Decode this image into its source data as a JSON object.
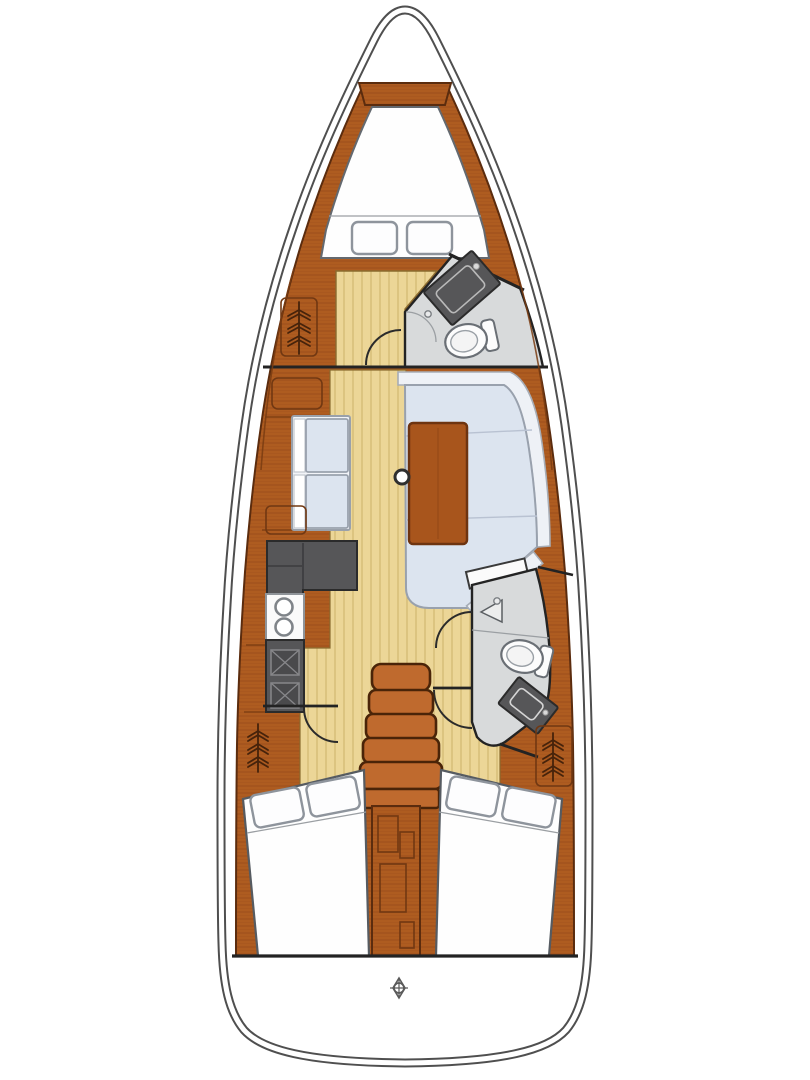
{
  "page": {
    "background": "#ffffff",
    "description": "Top-down interior floor plan diagram of a sailing yacht, bow pointing up, no visible text labels"
  },
  "colors": {
    "hull_line": "#4f4f4f",
    "hull_fill": "#ffffff",
    "wood": "#ae5c20",
    "wood_grain": "#96491a",
    "wood_edge": "#5b2c0e",
    "wood_light": "#b8652a",
    "table_wood": "#a8551c",
    "steps": "#bf6a2e",
    "steps_edge": "#4a2408",
    "floor": "#ecd697",
    "floor_line": "#c9ab62",
    "berth": "#fefefe",
    "berth_edge": "#60656d",
    "pillow": "#fdfdfe",
    "pillow_edge": "#8e949c",
    "cushion": "#dce4ef",
    "cushion_back": "#eef1f6",
    "cushion_edge": "#99a1ad",
    "counter": "#565658",
    "counter_inner": "#4a4a4c",
    "counter_edge": "#2b2b2b",
    "head_floor": "#d8dadb",
    "fixture": "#fcfcfc",
    "fixture_edge": "#6a6f75",
    "trim_dark": "#232323"
  },
  "rooms": [
    {
      "name": "anchor-locker",
      "position": "bow"
    },
    {
      "name": "forward-cabin",
      "features": [
        "v-berth-double-bed",
        "two-pillows",
        "hanging-locker",
        "door-swing-arc"
      ]
    },
    {
      "name": "forward-head",
      "features": [
        "toilet",
        "vanity-sink",
        "shower-drain",
        "shower-door-arc"
      ]
    },
    {
      "name": "saloon",
      "features": [
        "port-settee-two-cushions",
        "starboard-u-settee",
        "dining-table",
        "mast-post"
      ]
    },
    {
      "name": "galley",
      "features": [
        "l-shaped-counter",
        "double-round-sink",
        "two-burner-stove"
      ]
    },
    {
      "name": "aft-head",
      "features": [
        "toilet",
        "vanity-sink",
        "shower-drain",
        "open-door-leaf"
      ]
    },
    {
      "name": "companionway",
      "features": [
        "five-steps",
        "engine-box-divider"
      ]
    },
    {
      "name": "port-aft-cabin",
      "features": [
        "double-berth",
        "two-pillows",
        "hanging-locker",
        "door-swing-arc"
      ]
    },
    {
      "name": "starboard-aft-cabin",
      "features": [
        "double-berth",
        "two-pillows",
        "hanging-locker",
        "door-swing-arc"
      ]
    },
    {
      "name": "transom",
      "features": [
        "helm-compass-marker"
      ]
    }
  ],
  "icons": {
    "hanging_locker": "clothes-hanger-stack",
    "stove_burner": "square-with-x",
    "sink_galley": "double-round-basins",
    "helm_marker": "circle-in-diamond-with-ticks",
    "door_swing": "quarter-circle-arc"
  },
  "counts": {
    "pillows": 6,
    "toilets": 2,
    "head_sinks": 2,
    "galley_sink_basins": 2,
    "stove_burners": 2,
    "companionway_steps": 5,
    "hanging_locker_symbols": 3
  }
}
